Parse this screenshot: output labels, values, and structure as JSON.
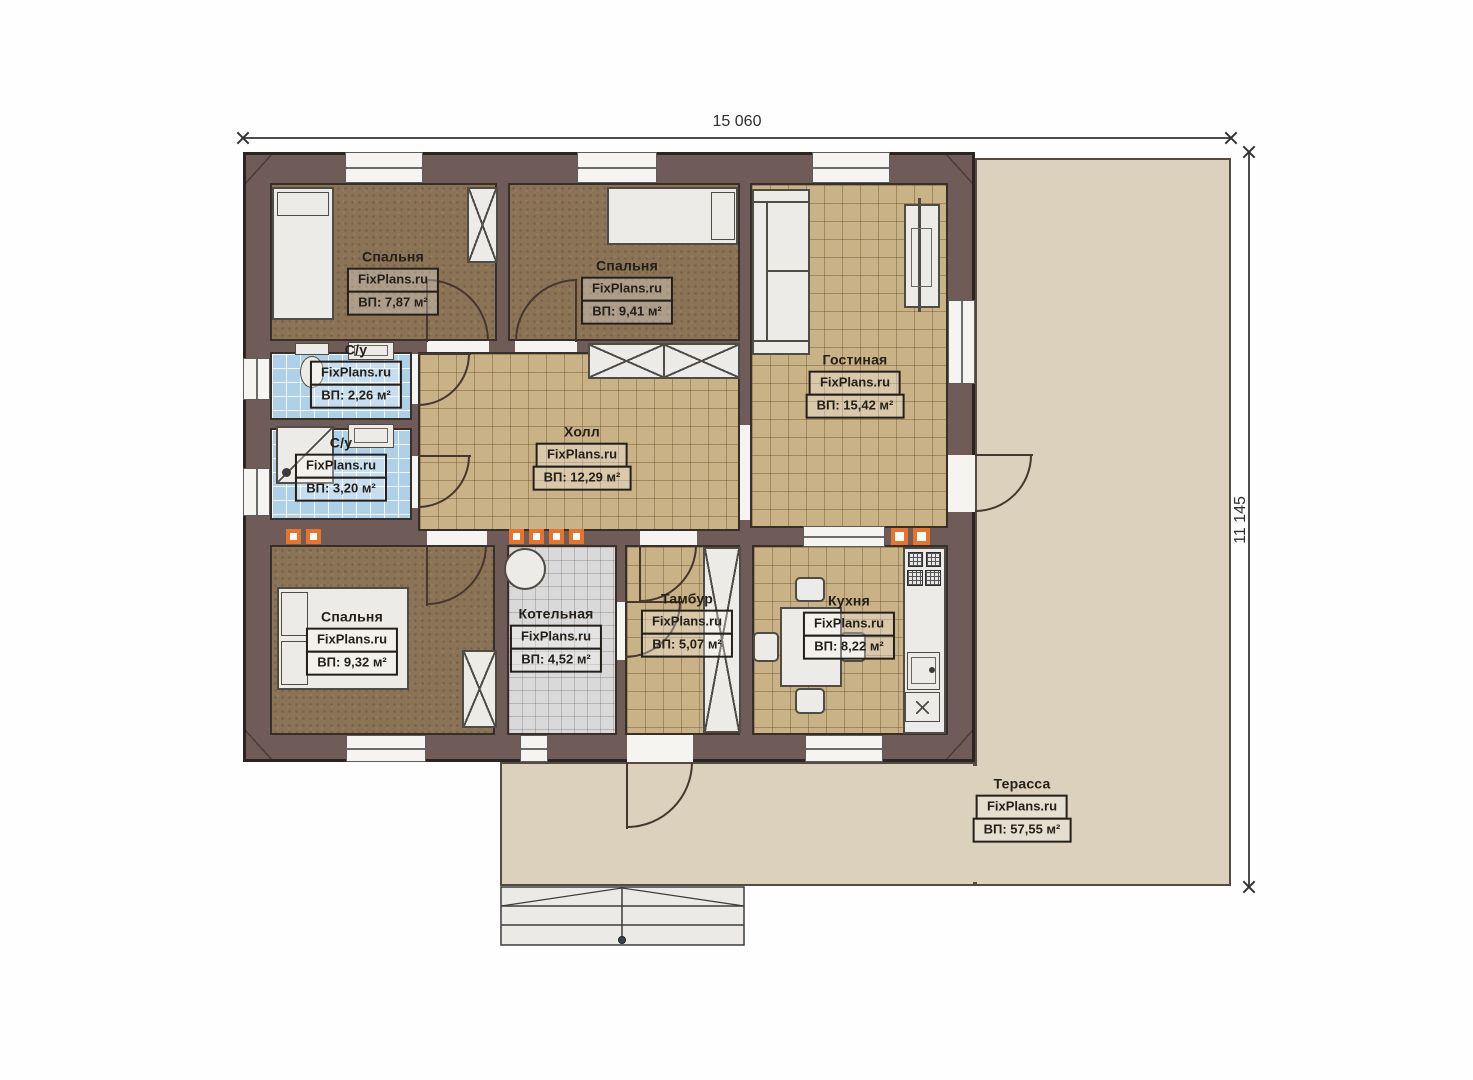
{
  "watermark": "FixPlans.ru",
  "dimensions": {
    "width": "15 060",
    "height": "11 145"
  },
  "rooms": [
    {
      "key": "bedroom-1",
      "name": "Спальня",
      "brand": "FixPlans.ru",
      "area": "ВП: 7,87 м²"
    },
    {
      "key": "bedroom-2",
      "name": "Спальня",
      "brand": "FixPlans.ru",
      "area": "ВП: 9,41 м²"
    },
    {
      "key": "living-room",
      "name": "Гостиная",
      "brand": "FixPlans.ru",
      "area": "ВП: 15,42 м²"
    },
    {
      "key": "bathroom-1",
      "name": "С/у",
      "brand": "FixPlans.ru",
      "area": "ВП: 2,26 м²"
    },
    {
      "key": "bathroom-2",
      "name": "С/у",
      "brand": "FixPlans.ru",
      "area": "ВП: 3,20 м²"
    },
    {
      "key": "hall",
      "name": "Холл",
      "brand": "FixPlans.ru",
      "area": "ВП: 12,29 м²"
    },
    {
      "key": "bedroom-3",
      "name": "Спальня",
      "brand": "FixPlans.ru",
      "area": "ВП: 9,32 м²"
    },
    {
      "key": "boiler-room",
      "name": "Котельная",
      "brand": "FixPlans.ru",
      "area": "ВП: 4,52 м²"
    },
    {
      "key": "vestibule",
      "name": "Тамбур",
      "brand": "FixPlans.ru",
      "area": "ВП: 5,07 м²"
    },
    {
      "key": "kitchen",
      "name": "Кухня",
      "brand": "FixPlans.ru",
      "area": "ВП: 8,22 м²"
    },
    {
      "key": "terrace",
      "name": "Терасса",
      "brand": "FixPlans.ru",
      "area": "ВП: 57,55 м²"
    }
  ],
  "colors": {
    "wall": "#6f5c59",
    "tile_tan": "#c9b286",
    "tile_blue": "#aed0e8",
    "tile_gray": "#d9d9d9",
    "wood_floor": "#8b7355",
    "terrace": "#dcd1bc",
    "vent_marker": "#e8742c"
  }
}
